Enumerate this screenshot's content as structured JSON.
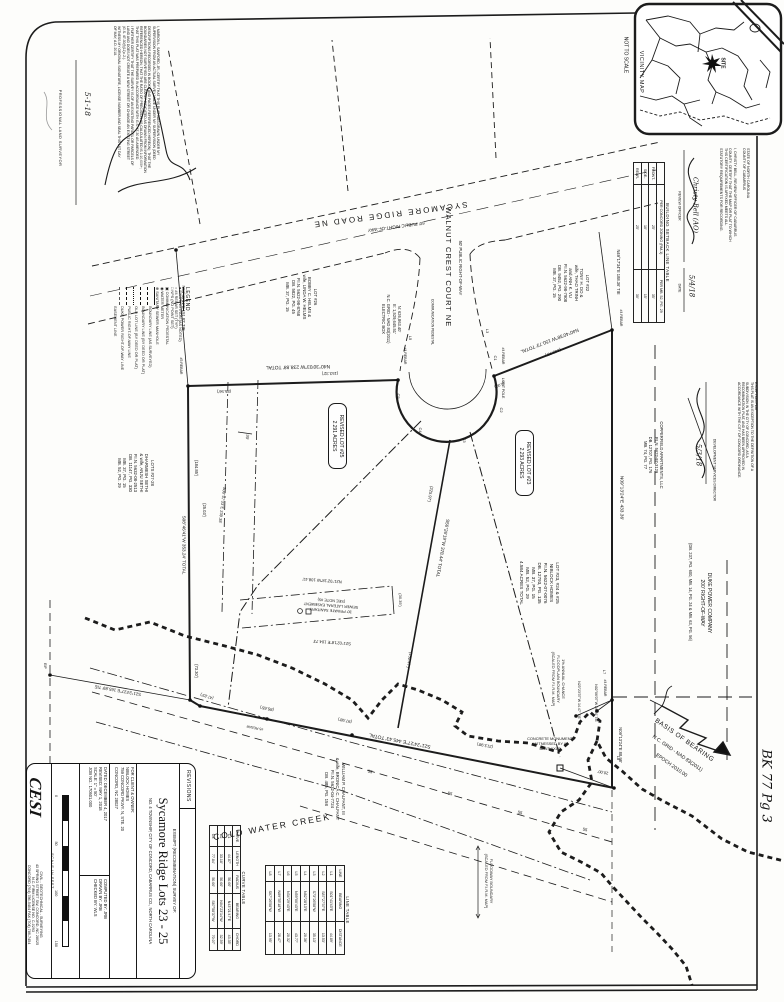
{
  "roads": {
    "sycamore": "SYCAMORE RIDGE ROAD NE",
    "sycamore_row": "60' PUBLIC RIGHT-OF-WAY",
    "walnut": "WALNUT CREST COURT NE",
    "walnut_row": "50' PUBLIC RIGHT-OF-WAY",
    "creek": "COLD WATER CREEK"
  },
  "vicinity": {
    "title": "VICINITY MAP",
    "scale": "NOT TO SCALE",
    "site": "SITE"
  },
  "basis": {
    "l1": "BASIS OF BEARING",
    "l2": "N.C. GRID - NAD 83(2011)",
    "l3": "EPOCH 2010.00"
  },
  "annotations": {
    "book_page": "BK 77 Pg 3"
  },
  "bearings": {
    "n_total": "N40°30'03\"W 238.88' TOTAL",
    "n_s1": "(153.32')",
    "n_s2": "(85.56')",
    "ne_total": "N40°40'38\"W 150.73' TOTAL",
    "ne_s1": "(145.73')",
    "ne_s2": "(5.00')",
    "e_main": "N09°13'24\"E 433.36'",
    "e_low": "N09°13'24\"E 88.98'",
    "s_total": "S21°24'27\"E 445.43' TOTAL",
    "s_s1": "(85.65')",
    "s_s2": "(97.98')",
    "s_s3": "(213.98')",
    "s_jog": "(47.83')",
    "sw_tie": "S21°24'27\"E 165.89' TIE",
    "w_total": "S08°46'41\"W 353.24' TOTAL",
    "w_s1": "(184.85')",
    "w_s2": "(25.03')",
    "w_s3": "(73.30')",
    "a_tie": "N04°46'41\"E 151.82' TIE",
    "d_tie": "N49°17'34\"E 188.36' TIE",
    "div_total": "S56°26'19\"W 378.44' TOTAL",
    "div_s1": "(225.97')",
    "div_s2": "(152.47')",
    "lat_n": "N21°02'18\"W 108.41'",
    "lat_s": "S21°02'18\"E 104.73'",
    "lat_w": "(30.35')",
    "sewer": "S00°47'33\"E 239.38'",
    "sewer_w": "30'",
    "tie_m1": "N23°23'37\"W 14.47' TIE",
    "tie_m2": "N02°06'07\"W 24.64' TIE",
    "seg20": "20.00'"
  },
  "markers": {
    "rebar4": "#4 REBAR",
    "rebar5": "#5 REBAR",
    "eip": "EIP",
    "light": "LIGHT POLE",
    "comm": "COMMUNICATION PEDESTAL",
    "c1": "C1",
    "c2": "C2",
    "c3": "C3",
    "c4": "C4",
    "c5": "C5",
    "l3": "L3",
    "l5": "L5",
    "l7": "L7",
    "l8": "L8",
    "f55": "55"
  },
  "blocks": {
    "lot23": "REVISED LOT #23\n2.293 ACRES",
    "lot25": "REVISED LOT #25\n2.291 ACRES",
    "owner": "LOT #23, #24 & #25\nNIBLOCK HOMES\nP.I.N. 5622-07-0076\nDB. 12793, PG. 135\nMB. 37, PG. 15\nMB. 52, PG. 29\n4.584 ACRES TOTAL",
    "lot26": "LOT #26\nBOBBY C. HELMS &\nwife, LINDA W. HELMS\nP.I.N. 5622-98-8768\nDB. 5822, PG. 45\nMB. 37, PG. 15",
    "lot22": "LOT #22\nTONY H. DO &\nwife, THAO TRINH\nand ANH K. VU\nP.I.N. 5622-98-7908\nDB. 9452, PG. 290\nMB. 37, PG. 15",
    "sethi": "LOTS #27-28\nDHARMESH SETHI\n& wife, ANJU SETHI\nP.I.N. 5632-08-2513\nDB. 11147, PG. 330\nMB. 37, PG. 15\nMB. 52, PG. 29",
    "chalfant": "WILLIAM P. CHALFANT, III\n& wife, BRONICA C. CHALFANT\nP.I.N. 5632-04-7724\nDB. 485, PG. 158",
    "copperfield": "COPPERFIELD APARTMENTS, LLC\nP.I.N. 5622-97-3129\nDB. 12707, PG. 176\nMB. 74, PG. 77",
    "duke": "DUKE POWER COMPANY\n200' RIGHT-OF-WAY",
    "duke_ref": "(DB. 237, PG. 600, MB. 14, PG. 24 & MB. 63, PG. 56)",
    "floodplain": "1% ANNUAL CHANCE\nFLOODPLAIN BOUNDARY\n(SCALED FROM F.I.R.M. MAP)",
    "floodway": "FLOODWAY BOUNDARY\n(SCALED FROM F.I.R.M. MAP)",
    "monument": "CONCRETE MONUMENT\nWITNESSED BY A\nBENT AXLE",
    "gridpt": "N: 626,863.40'\nE: 1,529,645.51'\nN.C. GRID - NAD 83(2011)\nELECTRIC BOX",
    "sewer_easement": "30' PRIVATE SANITARY\nSEWER LATERAL EASEMENT\n(SEE NOTE #5)"
  },
  "legend": {
    "title": "LEGEND",
    "symbols": [
      [
        "●",
        "EXISTING IRON (AS NOTED)"
      ],
      [
        "○",
        "#4 REBAR SET (TYP.)"
      ],
      [
        "□",
        "NPS (NO POINT SET)"
      ],
      [
        "▣",
        "COMMUNICATION PEDESTAL"
      ],
      [
        "◉",
        "WATER METER"
      ],
      [
        "⊕",
        "SANITARY SEWER MANHOLE"
      ]
    ],
    "lines": [
      [
        "solid",
        "BOUNDARY LINE (AS SURVEYED)"
      ],
      [
        "dashed",
        "BOUNDARY LINE (BY DEED OR PLAT)"
      ],
      [
        "dashdot",
        "OLD LOT LINE (BY DEED OR PLAT)"
      ],
      [
        "dashed2",
        "PUBLIC RIGHT-OF-WAY LINE"
      ],
      [
        "longdash",
        "DUKE POWER RIGHT-OF-WAY LINE"
      ],
      [
        "dashdotdot",
        "EASEMENT LINE"
      ]
    ]
  },
  "tables": {
    "setback": {
      "title": "BUILDING SETBACK LINE TABLE",
      "headers": [
        "",
        "PER CONCORD ZONING (RM-1)",
        "PER MB. 52, PG. 29"
      ],
      "rows": [
        [
          "FRONT-",
          "25'",
          "35'"
        ],
        [
          "SIDE-",
          "10'",
          "15'"
        ],
        [
          "REAR-",
          "25'",
          "30'"
        ]
      ]
    },
    "line": {
      "title": "LINE TABLE",
      "headers": [
        "LINE",
        "BEARING",
        "DISTANCE"
      ],
      "rows": [
        [
          "L1",
          "S01°41'43\"E",
          "44.89'"
        ],
        [
          "L2",
          "S87°27'37\"E",
          "13.53'"
        ],
        [
          "L3",
          "S73°26'58\"W",
          "35.13'"
        ],
        [
          "L4",
          "N82°28'13\"E",
          "20.36'"
        ],
        [
          "L5",
          "N59°00'43\"E",
          "43.77'"
        ],
        [
          "L6",
          "N34°29'43\"E",
          "20.32'"
        ],
        [
          "L7",
          "N89°35'18\"W",
          "28.47'"
        ],
        [
          "L8",
          "S07°26'58\"W",
          "13.95'"
        ]
      ]
    },
    "curve": {
      "title": "CURVE TABLE",
      "headers": [
        "CURVE",
        "LENGTH",
        "RADIUS",
        "BEARING",
        "CHORD"
      ],
      "rows": [
        [
          "C1",
          "44.87'",
          "50.00'",
          "N43°21'47\"E",
          "43.35'"
        ],
        [
          "C2",
          "33.18'",
          "50.00'",
          "N04°23'14\"W",
          "32.59'"
        ],
        [
          "C3",
          "77.84'",
          "50.00'",
          "S67°58'37\"W",
          "70.07'"
        ]
      ]
    }
  },
  "titleblock": {
    "revisions": "REVISIONS",
    "survey_type": "EXEMPT (RECOMBINATION) SURVEY OF:",
    "title": "Sycamore Ridge Lots 23 - 25",
    "location": "NO. 4 TOWNSHIP, CITY OF CONCORD, CABARRUS CO., NORTH CAROLINA",
    "client_label": "FOR CLIENT & OWNER:",
    "client": "NIBLOCK HOMES\n759 CONCORD PKWY. N, STE. 20\nCONCORD, NC 28027",
    "dated": "DATED: DECEMBER 4, 2017",
    "revised": "REVISED: MAY 1, 2018",
    "scale": "SCALE: 1\" = 50'",
    "job": "JOB NO.: 170501.000",
    "computed": "COMPUTED BY:  JRB",
    "drawn": "DRAWN BY:  JRB",
    "checked": "CHECKED BY:  WLS",
    "scale_bar_label": "SCALE IN FEET",
    "scale_ticks": [
      "0",
      "50",
      "100",
      "150"
    ],
    "logo": "CESI",
    "firm1": "CIVIL - GEOTECHNICAL - SURVEYING",
    "firm2": "43 SPRING STREET SW, CONCORD, NC 28025",
    "firm3": "N.C. FIRM LICENSE NO. C-0293",
    "firm4": "CONCORD (704) 786-5404   FAX (704) 786-7454"
  },
  "certs": {
    "surveyor": {
      "body": "I, MARION L. SANFORD, JR., CERTIFY THAT THIS PLAT WAS DRAWN UNDER MY\nSUPERVISION FROM AN ACTUAL SURVEY MADE UNDER MY SUPERVISION (DEED\nDESCRIPTIONS RECORDED IN BOOKS AND PAGES REFERENCED HEREON); THAT THE\nBOUNDARIES NOT SURVEYED ARE CLEARLY INDICATED AS DRAWN FROM INFORMATION\nREFERENCED HEREON; THAT THE RATIO OF PRECISION AS CALCULATED IS 1:10,000+;\nTHAT THIS PLAT WAS PREPARED IN ACCORDANCE WITH G.S. 47-30 AS AMENDED.\nI FURTHER CERTIFY THAT THE SURVEY IS OF AN EXISTING PARCEL OR PARCELS OF\nLAND AND DOES NOT CREATE A NEW STREET OR CHANGE AN EXISTING STREET\n(G.S. 47-30(f)(11)c.2.).\nWITNESS MY ORIGINAL SIGNATURE, LICENSE NUMBER AND SEAL THIS 1ST DAY\nOF MAY, A.D. 2018.",
      "role": "PROFESSIONAL LAND SURVEYOR",
      "date": "5-1-18"
    },
    "review": {
      "body": "STATE OF NORTH CAROLINA\nCOUNTY OF CABARRUS\n\nI, CHRISTY BELL, REVIEW OFFICER OF CABARRUS\nCOUNTY, CERTIFY THAT THE MAP OR PLAT TO WHICH\nTHIS CERTIFICATION IS AFFIXED MEETS ALL\nSTATUTORY REQUIREMENTS FOR RECORDING.",
      "signature": "Christy Bell (AO)",
      "sig_label": "REVIEW OFFICER",
      "date": "5/4/18",
      "date_label": "DATE"
    },
    "exception": {
      "body": "EXCEPTION PLAT\nTHIS PLAT IS AN EXCEPTION TO THE DEFINITION OF A\nSUBDIVISION IN THE CITY OF CONCORD, AS A\nRECOMBINATION PLAT, AND HAS BEEN APPROVED IN\nACCORDANCE WITH THE CITY OF CONCORD ORDINANCE.",
      "date": "5/3/18",
      "role": "DEVELOPMENT SERVICES DIRECTOR"
    }
  }
}
